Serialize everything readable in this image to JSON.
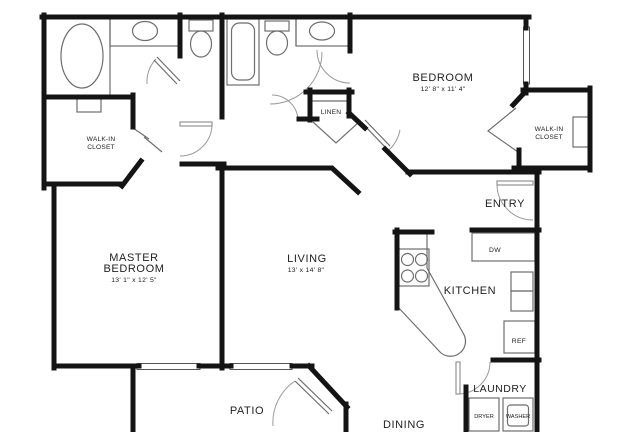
{
  "plan": {
    "title": "Two bedroom apartment floor plan",
    "rooms": {
      "master_bedroom": {
        "name_line1": "MASTER",
        "name_line2": "BEDROOM",
        "dims": "13' 1\" x 12' 5\""
      },
      "bedroom": {
        "name": "BEDROOM",
        "dims": "12' 8\" x 11' 4\""
      },
      "living": {
        "name": "LIVING",
        "dims": "13' x 14' 8\""
      },
      "kitchen": {
        "name": "KITCHEN"
      },
      "dining": {
        "name": "DINING"
      },
      "patio": {
        "name": "PATIO"
      },
      "entry": {
        "name": "ENTRY"
      },
      "laundry": {
        "name": "LAUNDRY"
      },
      "linen": {
        "name": "LINEN"
      },
      "walk_in_closet_left": {
        "line1": "WALK-IN",
        "line2": "CLOSET"
      },
      "walk_in_closet_right": {
        "line1": "WALK-IN",
        "line2": "CLOSET"
      }
    },
    "appliances": {
      "dishwasher": "DW",
      "refrigerator": "REF",
      "dryer": "DRYER",
      "washer": "WASHER"
    },
    "colors": {
      "wall": "#141414",
      "fixture_line": "#6e6e6e",
      "door_arc": "#9a9a9a",
      "background": "#ffffff",
      "text": "#222222"
    }
  }
}
